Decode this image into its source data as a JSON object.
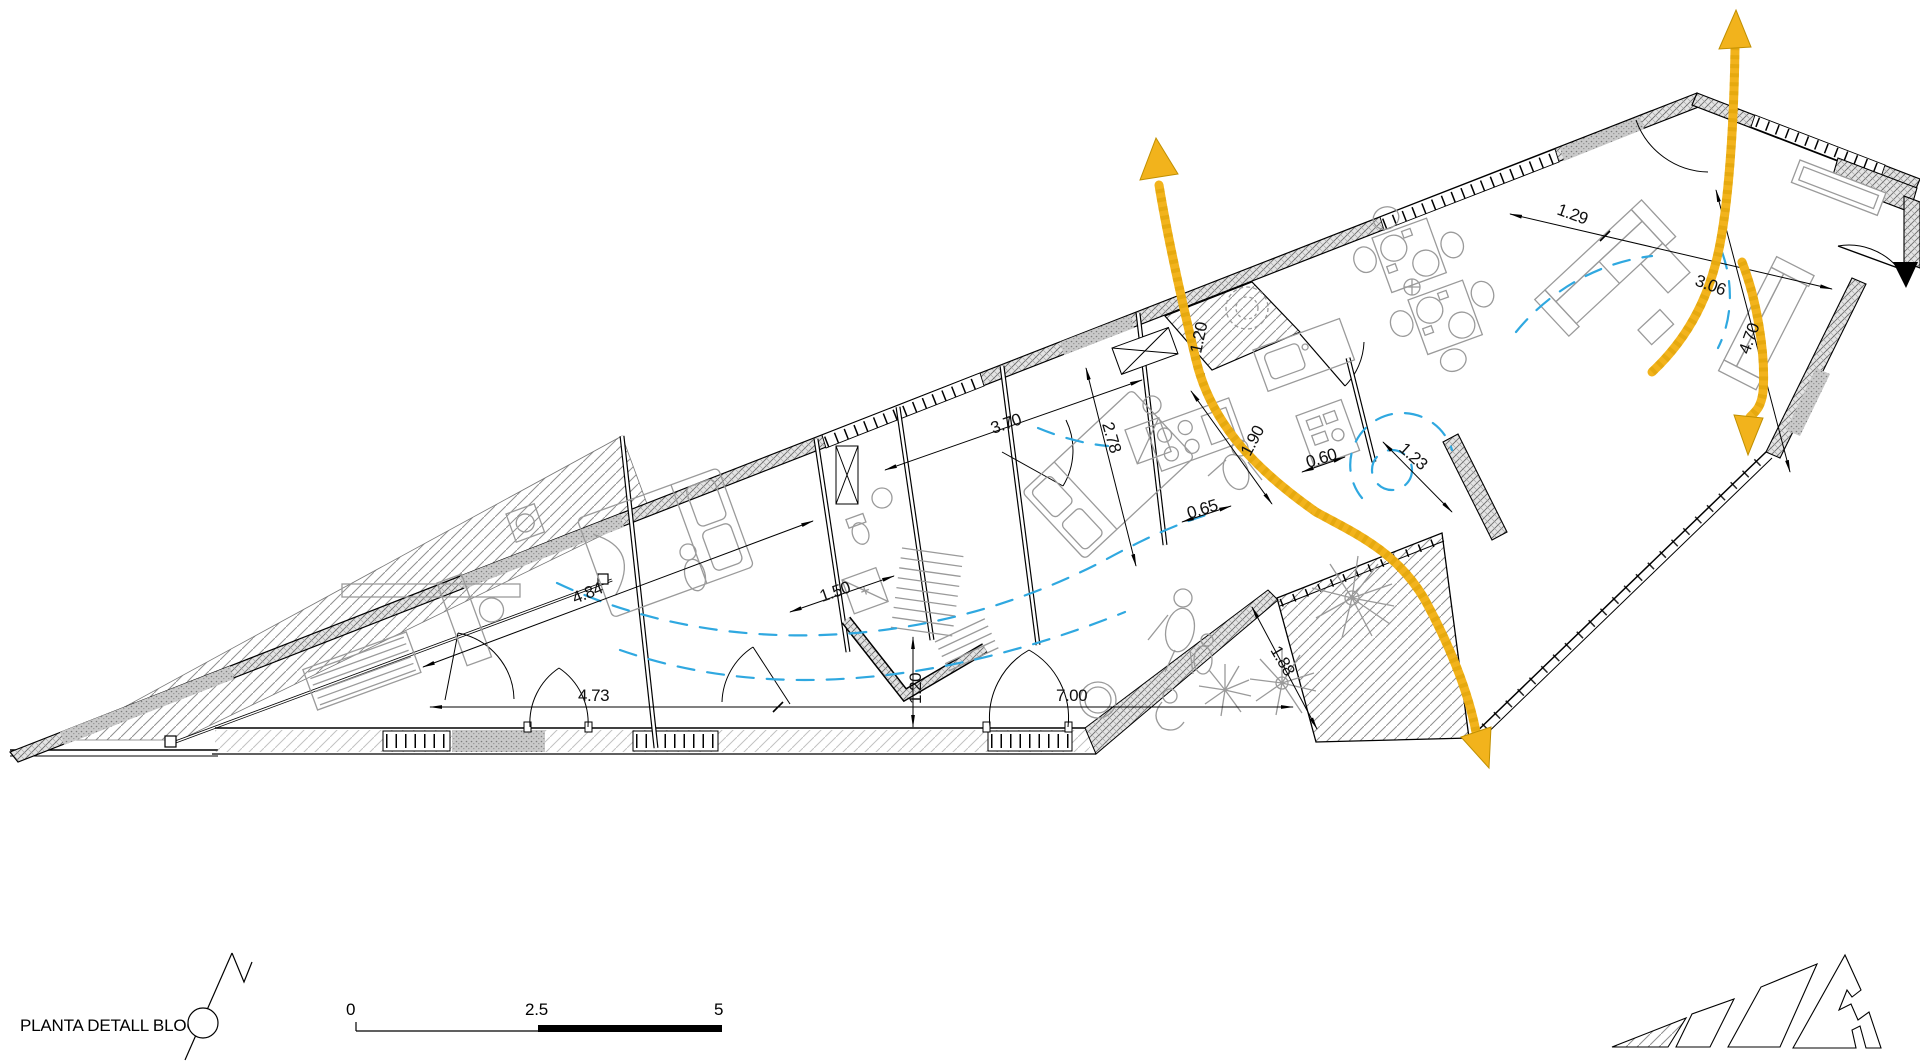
{
  "colors": {
    "flow_arrow_yellow": "#F2B31C",
    "airflow_blue": "#2FA8E0",
    "furniture_gray": "#9A9A9A",
    "drawing_black": "#000000"
  },
  "legend": {
    "title": "PLANTA DETALL BLOC 1",
    "scale_bar": {
      "start_label": "0",
      "mid_label": "2.5",
      "end_label": "5"
    }
  },
  "plan": {
    "dimensions": [
      {
        "value": "4.84",
        "transform": "translate(575,604) rotate(-22)"
      },
      {
        "value": "4.73",
        "transform": "translate(578,701) rotate(0)"
      },
      {
        "value": "1.50",
        "transform": "translate(822,602) rotate(-19)"
      },
      {
        "value": "3.70",
        "transform": "translate(993,434) rotate(-19)"
      },
      {
        "value": "2.78",
        "transform": "translate(1102,424) rotate(74)"
      },
      {
        "value": "1.20",
        "transform": "translate(1201,354) rotate(-78)"
      },
      {
        "value": "1.90",
        "transform": "translate(1250,457) rotate(-62)"
      },
      {
        "value": "0.60",
        "transform": "translate(1308,468) rotate(-17)"
      },
      {
        "value": "0.65",
        "transform": "translate(1189,519) rotate(-17)"
      },
      {
        "value": "1.23",
        "transform": "translate(1398,450) rotate(42)"
      },
      {
        "value": "1.88",
        "transform": "translate(1270,650) rotate(60)"
      },
      {
        "value": "1.20",
        "transform": "translate(921,704) rotate(-90)"
      },
      {
        "value": "7.00",
        "transform": "translate(1056,701) rotate(0)"
      },
      {
        "value": "1.29",
        "transform": "translate(1556,214) rotate(20)"
      },
      {
        "value": "3.06",
        "transform": "translate(1694,285) rotate(20)"
      },
      {
        "value": "4.70",
        "transform": "translate(1749,355) rotate(-70)"
      }
    ]
  }
}
